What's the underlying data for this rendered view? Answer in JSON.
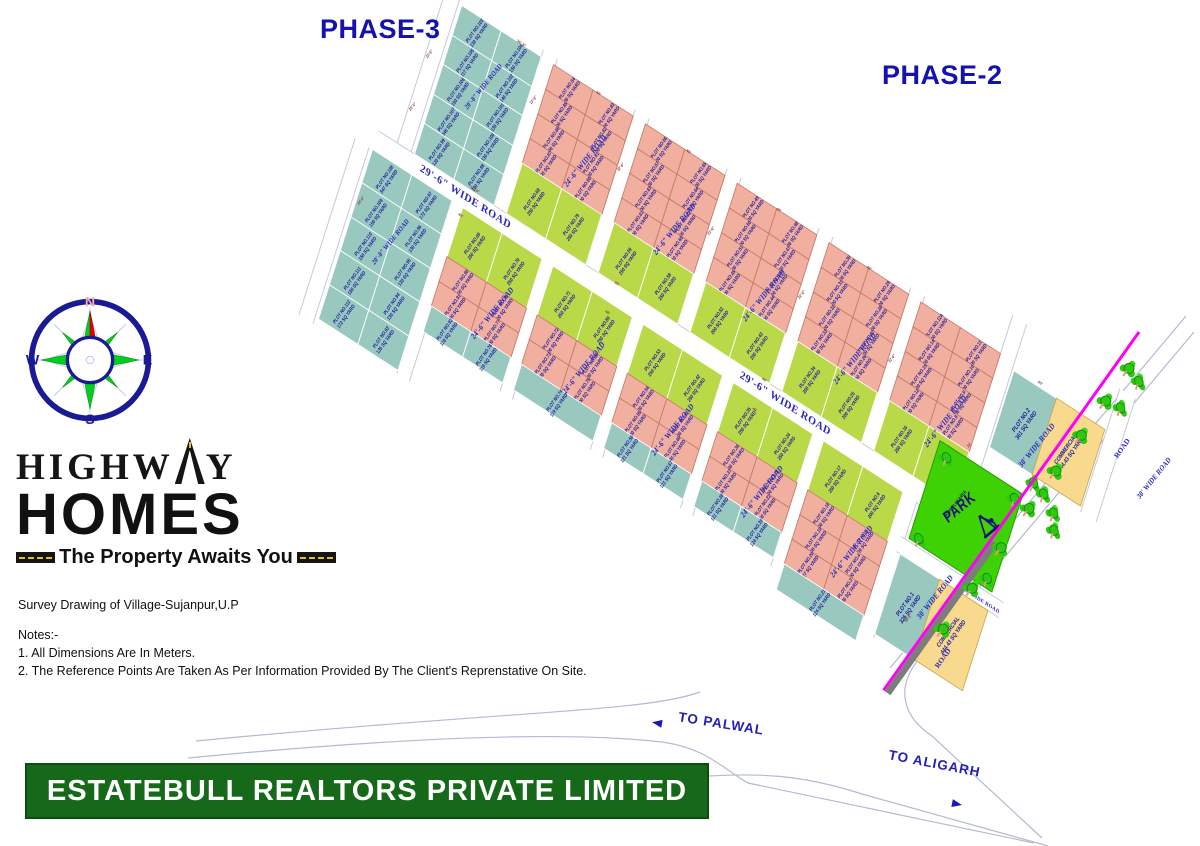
{
  "phase_labels": {
    "phase3": "PHASE-3",
    "phase2": "PHASE-2"
  },
  "logo": {
    "word1_left": "HIGHW",
    "word1_right": "Y",
    "word2": "HOMES",
    "tagline": "The Property Awaits You"
  },
  "survey_line": "Survey Drawing of Village-Sujanpur,U.P",
  "notes": [
    "Notes:-",
    "1. All Dimensions Are In Meters.",
    "2. The Reference Points Are Taken As Per Information Provided By The Client's Reprenstative On Site."
  ],
  "banner": "ESTATEBULL REALTORS PRIVATE LIMITED",
  "compass": {
    "n": "N",
    "e": "E",
    "s": "S",
    "w": "W"
  },
  "junction": {
    "palwal": "TO PALWAL",
    "aligarh": "TO ALIGARH",
    "road1": "ROAD",
    "road2": "ROAD"
  },
  "park": {
    "label": "PARK",
    "sub": "KIDS PLAY AREA"
  },
  "colors": {
    "teal": "#98c8be",
    "pink": "#f0af9f",
    "green": "#b9d948",
    "park_green": "#3ed104",
    "commercial_yellow": "#f9d98d",
    "plot_text": "#1c189c",
    "road_label": "#2a28c2",
    "banner_green": "#17691a",
    "phase_blue": "#1512b0",
    "boundary_magenta": "#ff00f0",
    "tick_maroon": "#8a4030"
  },
  "plan": {
    "blocks": [
      {
        "id": "phase3-block-a",
        "x": 0,
        "y": 0,
        "w": 96,
        "sections": [
          {
            "c": "teal",
            "rh": 33.6,
            "rows": [
              [
                "103|130",
                "104|150"
              ],
              [
                "105|117",
                "102|140"
              ],
              [
                "106|150",
                "101|130"
              ],
              [
                "107|345",
                "100|130"
              ],
              [
                "99|130",
                "98|130"
              ]
            ]
          }
        ]
      },
      {
        "id": "phase3-block-b",
        "x": -44,
        "y": 190,
        "w": 96,
        "sections": [
          {
            "c": "teal",
            "rh": 38.4,
            "rows": [
              [
                "108|347",
                "97|172"
              ],
              [
                "109|150",
                "96|130"
              ],
              [
                "110|150",
                "95|130"
              ],
              [
                "111|150",
                "94|130"
              ],
              [
                "112|172",
                "93|135"
              ]
            ]
          }
        ]
      },
      {
        "id": "row1-block-1",
        "x": 112,
        "y": 0,
        "w": 96,
        "sections": [
          {
            "c": "pink",
            "rh": 28,
            "rows": [
              [
                "84|100",
                "83|100"
              ],
              [
                "85|100",
                "82|100"
              ],
              [
                "86|100",
                "81|100"
              ],
              [
                "87|100",
                "80|100"
              ]
            ]
          },
          {
            "c": "green",
            "rh": 56,
            "rows": [
              [
                "68|250",
                "79|250"
              ]
            ]
          }
        ]
      },
      {
        "id": "row1-block-2",
        "x": 224,
        "y": 0,
        "w": 96,
        "sections": [
          {
            "c": "pink",
            "rh": 28,
            "rows": [
              [
                "66|100",
                "65|100"
              ],
              [
                "67|100",
                "64|100"
              ],
              [
                "63|100",
                "62|100"
              ],
              [
                "61|100",
                "60|100"
              ]
            ]
          },
          {
            "c": "green",
            "rh": 56,
            "rows": [
              [
                "59|250",
                "58|250"
              ]
            ]
          }
        ]
      },
      {
        "id": "row1-block-3",
        "x": 336,
        "y": 0,
        "w": 96,
        "sections": [
          {
            "c": "pink",
            "rh": 28,
            "rows": [
              [
                "49|100",
                "48|100"
              ],
              [
                "50|100",
                "47|100"
              ],
              [
                "51|100",
                "46|100"
              ],
              [
                "45|100",
                "44|100"
              ]
            ]
          },
          {
            "c": "green",
            "rh": 56,
            "rows": [
              [
                "52|200",
                "43|200"
              ]
            ]
          }
        ]
      },
      {
        "id": "row1-block-4",
        "x": 448,
        "y": 0,
        "w": 96,
        "sections": [
          {
            "c": "pink",
            "rh": 28,
            "rows": [
              [
                "30|100",
                "29|100"
              ],
              [
                "31|100",
                "28|100"
              ],
              [
                "32|100",
                "27|100"
              ],
              [
                "33|100",
                "26|100"
              ]
            ]
          },
          {
            "c": "green",
            "rh": 56,
            "rows": [
              [
                "34|200",
                "25|200"
              ]
            ]
          }
        ]
      },
      {
        "id": "row1-block-5",
        "x": 560,
        "y": 0,
        "w": 96,
        "sections": [
          {
            "c": "pink",
            "rh": 28,
            "rows": [
              [
                "12A|100",
                "11|100"
              ],
              [
                "14|100",
                "10|100"
              ],
              [
                "15|100",
                "9|100"
              ],
              [
                "12|100",
                "8|100"
              ]
            ]
          },
          {
            "c": "green",
            "rh": 56,
            "rows": [
              [
                "16|250",
                "7|200"
              ]
            ]
          }
        ]
      },
      {
        "id": "row2-block-1",
        "x": 66,
        "y": 190,
        "w": 96,
        "sections": [
          {
            "c": "green",
            "rh": 56,
            "rows": [
              [
                "69|250",
                "70|250"
              ]
            ]
          },
          {
            "c": "pink",
            "rh": 28,
            "rows": [
              [
                "90|100",
                "78|100"
              ],
              [
                "91|100",
                "77|100"
              ]
            ]
          },
          {
            "c": "teal",
            "rh": 28,
            "rows": [
              [
                "92|118",
                "76|119"
              ]
            ]
          }
        ]
      },
      {
        "id": "row2-block-2",
        "x": 176,
        "y": 190,
        "w": 96,
        "sections": [
          {
            "c": "green",
            "rh": 56,
            "rows": [
              [
                "71|250",
                "89|250"
              ]
            ]
          },
          {
            "c": "pink",
            "rh": 28,
            "rows": [
              [
                "72|100",
                "88|100"
              ],
              [
                "73|100",
                "75|100"
              ]
            ]
          },
          {
            "c": "teal",
            "rh": 28,
            "rows": [
              [
                "74|119"
              ]
            ]
          }
        ]
      },
      {
        "id": "row2-block-3",
        "x": 286,
        "y": 190,
        "w": 96,
        "sections": [
          {
            "c": "green",
            "rh": 56,
            "rows": [
              [
                "53|250",
                "42|250"
              ]
            ]
          },
          {
            "c": "pink",
            "rh": 28,
            "rows": [
              [
                "54|100",
                "41|100"
              ],
              [
                "55|100",
                "40|100"
              ]
            ]
          },
          {
            "c": "teal",
            "rh": 28,
            "rows": [
              [
                "56|121",
                "57|121"
              ]
            ]
          }
        ]
      },
      {
        "id": "row2-block-4",
        "x": 396,
        "y": 190,
        "w": 96,
        "sections": [
          {
            "c": "green",
            "rh": 56,
            "rows": [
              [
                "35|250",
                "24|250"
              ]
            ]
          },
          {
            "c": "pink",
            "rh": 28,
            "rows": [
              [
                "36|100",
                "23|100"
              ],
              [
                "37|100",
                "22|100"
              ]
            ]
          },
          {
            "c": "teal",
            "rh": 28,
            "rows": [
              [
                "38|121",
                "39|124"
              ]
            ]
          }
        ]
      },
      {
        "id": "row2-block-5",
        "x": 506,
        "y": 190,
        "w": 96,
        "sections": [
          {
            "c": "green",
            "rh": 56,
            "rows": [
              [
                "17|250",
                "6|200"
              ]
            ]
          },
          {
            "c": "pink",
            "rh": 28,
            "rows": [
              [
                "18|100",
                "5|100"
              ],
              [
                "19|100",
                "4|100"
              ],
              [
                "20|127",
                "3|126"
              ]
            ]
          },
          {
            "c": "teal",
            "rh": 28,
            "rows": [
              [
                "21|124"
              ]
            ]
          }
        ]
      }
    ],
    "big_plots": [
      {
        "id": "plot-2",
        "x": 676,
        "y": 8,
        "w": 52,
        "h": 86,
        "c": "teal",
        "l1": "PLOT NO.2",
        "l2": "361 SQ YARD"
      },
      {
        "id": "commercial-1",
        "x": 728,
        "y": 8,
        "w": 58,
        "h": 86,
        "c": "yellow",
        "l1": "COMMERCIAL",
        "l2": "444.43 SQ YARD"
      },
      {
        "id": "plot-1",
        "x": 620,
        "y": 250,
        "w": 48,
        "h": 90,
        "c": "teal",
        "l1": "PLOT NO.1",
        "l2": "326 SQ YARD"
      },
      {
        "id": "commercial-2",
        "x": 668,
        "y": 250,
        "w": 58,
        "h": 90,
        "c": "yellow",
        "l1": "COMMERCIAL",
        "l2": "444.43 SQ YARD"
      }
    ],
    "park_rect": {
      "x": 623,
      "y": 118,
      "w": 100,
      "h": 110
    },
    "roads": [
      {
        "x": -22,
        "y": -8,
        "w": 16,
        "h": 182,
        "dir": "v"
      },
      {
        "x": 96,
        "y": -8,
        "w": 16,
        "h": 180,
        "dir": "v"
      },
      {
        "x": 208,
        "y": -8,
        "w": 16,
        "h": 180,
        "dir": "v"
      },
      {
        "x": 320,
        "y": -8,
        "w": 16,
        "h": 180,
        "dir": "v"
      },
      {
        "x": 432,
        "y": -8,
        "w": 16,
        "h": 180,
        "dir": "v"
      },
      {
        "x": 544,
        "y": -8,
        "w": 16,
        "h": 180,
        "dir": "v"
      },
      {
        "x": 656,
        "y": -44,
        "w": 16,
        "h": 216,
        "dir": "v"
      },
      {
        "x": 788,
        "y": -40,
        "w": 18,
        "h": 140,
        "dir": "v"
      },
      {
        "x": -44,
        "y": 168,
        "w": 716,
        "h": 22,
        "dir": "h"
      },
      {
        "x": -66,
        "y": 190,
        "w": 16,
        "h": 200,
        "dir": "v"
      },
      {
        "x": 52,
        "y": 190,
        "w": 14,
        "h": 196,
        "dir": "v"
      },
      {
        "x": 162,
        "y": 190,
        "w": 14,
        "h": 150,
        "dir": "v"
      },
      {
        "x": 272,
        "y": 190,
        "w": 14,
        "h": 150,
        "dir": "v"
      },
      {
        "x": 382,
        "y": 190,
        "w": 14,
        "h": 150,
        "dir": "v"
      },
      {
        "x": 492,
        "y": 190,
        "w": 14,
        "h": 150,
        "dir": "v"
      },
      {
        "x": 602,
        "y": 190,
        "w": 16,
        "h": 155,
        "dir": "v"
      },
      {
        "x": 615,
        "y": 232,
        "w": 125,
        "h": 16,
        "dir": "h"
      }
    ],
    "road_labels": [
      {
        "t": "29'-6\" WIDE ROAD",
        "x": 10,
        "y": 172,
        "r": 0,
        "s": 11.5
      },
      {
        "t": "29'-6\" WIDE ROAD",
        "x": 400,
        "y": 172,
        "r": 0,
        "s": 11.5
      },
      {
        "t": "20'-0\" WIDE ROAD",
        "x": -18,
        "y": 55,
        "r": -71,
        "s": 7
      },
      {
        "t": "20'-0\" WIDE ROAD",
        "x": -62,
        "y": 258,
        "r": -71,
        "s": 7
      },
      {
        "t": "24'-6\" WIDE ROAD",
        "x": 100,
        "y": 62,
        "r": -71,
        "s": 8
      },
      {
        "t": "24'-6\" WIDE ROAD",
        "x": 212,
        "y": 72,
        "r": -71,
        "s": 8
      },
      {
        "t": "24'-6\" WIDE ROAD",
        "x": 324,
        "y": 80,
        "r": -71,
        "s": 8
      },
      {
        "t": "24'-6\" WIDE ROAD",
        "x": 436,
        "y": 84,
        "r": -71,
        "s": 8
      },
      {
        "t": "24'-6\" WIDE ROAD",
        "x": 548,
        "y": 88,
        "r": -71,
        "s": 8
      },
      {
        "t": "24'-6\" WIDE ROAD",
        "x": 55,
        "y": 262,
        "r": -71,
        "s": 8
      },
      {
        "t": "24'-6\" WIDE ROAD",
        "x": 165,
        "y": 258,
        "r": -71,
        "s": 8
      },
      {
        "t": "24'-6\" WIDE ROAD",
        "x": 275,
        "y": 262,
        "r": -71,
        "s": 8
      },
      {
        "t": "24'-6\" WIDE ROAD",
        "x": 385,
        "y": 266,
        "r": -71,
        "s": 8
      },
      {
        "t": "24'-6\" WIDE ROAD",
        "x": 495,
        "y": 268,
        "r": -71,
        "s": 8
      },
      {
        "t": "30' WIDE ROAD",
        "x": 660,
        "y": 55,
        "r": -71,
        "s": 8
      },
      {
        "t": "30' WIDE ROAD",
        "x": 793,
        "y": 15,
        "r": -71,
        "s": 7.5
      },
      {
        "t": "30' WIDE ROAD",
        "x": 606,
        "y": 260,
        "r": -71,
        "s": 8
      },
      {
        "t": "30' WIDE ROAD",
        "x": 672,
        "y": 238,
        "r": 0,
        "s": 5.5
      }
    ],
    "ticks": [
      {
        "x": 60,
        "y": -6,
        "t": "36'-6\"",
        "r": 0
      },
      {
        "x": 160,
        "y": -6,
        "t": "40'",
        "r": 0
      },
      {
        "x": 270,
        "y": -6,
        "t": "40'",
        "r": 0
      },
      {
        "x": 380,
        "y": -6,
        "t": "40'",
        "r": 0
      },
      {
        "x": 490,
        "y": -6,
        "t": "40'",
        "r": 0
      },
      {
        "x": -30,
        "y": 60,
        "t": "22'-6\"",
        "r": 1
      },
      {
        "x": -30,
        "y": 120,
        "t": "25'-0\"",
        "r": 1
      },
      {
        "x": 90,
        "y": 40,
        "t": "22'-6\"",
        "r": 1
      },
      {
        "x": 200,
        "y": 50,
        "t": "22'-6\"",
        "r": 1
      },
      {
        "x": 312,
        "y": 55,
        "t": "22'-6\"",
        "r": 1
      },
      {
        "x": 424,
        "y": 60,
        "t": "22'-6\"",
        "r": 1
      },
      {
        "x": 536,
        "y": 65,
        "t": "22'-6\"",
        "r": 1
      },
      {
        "x": 60,
        "y": 160,
        "t": "30'-0\"",
        "r": 0
      },
      {
        "x": 240,
        "y": 162,
        "t": "40'",
        "r": 0
      },
      {
        "x": 420,
        "y": 163,
        "t": "40'",
        "r": 0
      },
      {
        "x": 60,
        "y": 193,
        "t": "40'",
        "r": 0
      },
      {
        "x": 240,
        "y": 195,
        "t": "40'",
        "r": 0
      },
      {
        "x": 420,
        "y": 197,
        "t": "40'",
        "r": 0
      },
      {
        "x": -52,
        "y": 240,
        "t": "24'-6\"",
        "r": 1
      },
      {
        "x": 648,
        "y": 100,
        "t": "23'",
        "r": 1
      },
      {
        "x": 700,
        "y": -2,
        "t": "40'",
        "r": 0
      },
      {
        "x": 636,
        "y": 300,
        "t": "36'-6\"",
        "r": 1
      }
    ],
    "trees": [
      {
        "x": 740,
        "y": 100
      },
      {
        "x": 756,
        "y": 112
      },
      {
        "x": 726,
        "y": 96
      },
      {
        "x": 762,
        "y": 128
      },
      {
        "x": 630,
        "y": 125
      },
      {
        "x": 712,
        "y": 122
      },
      {
        "x": 628,
        "y": 218
      },
      {
        "x": 710,
        "y": 214
      },
      {
        "x": 790,
        "y": -28
      },
      {
        "x": 800,
        "y": -64
      }
    ]
  },
  "boundary_trees_y": [
    -30,
    10,
    52,
    96,
    142,
    190,
    240,
    290
  ]
}
